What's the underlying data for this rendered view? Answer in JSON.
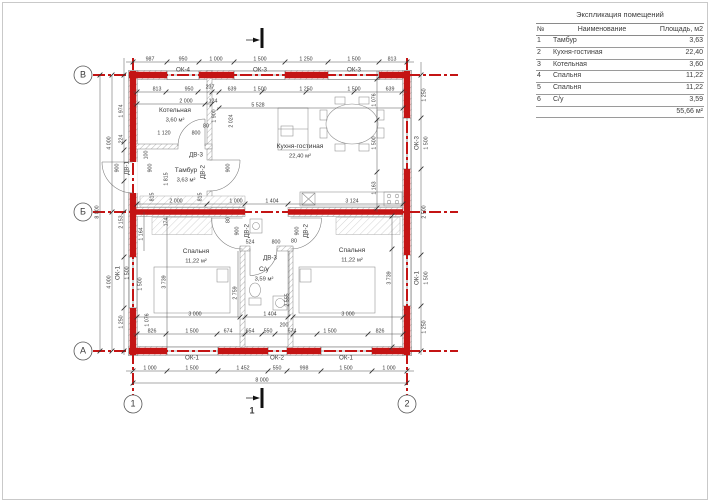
{
  "colors": {
    "axis_red": "#c41414"
  },
  "table": {
    "title": "Экспликация помещений",
    "headers": [
      "№",
      "Наименование",
      "Площадь, м2"
    ],
    "rows": [
      [
        "1",
        "Тамбур",
        "3,63"
      ],
      [
        "2",
        "Кухня-гостиная",
        "22,40"
      ],
      [
        "3",
        "Котельная",
        "3,60"
      ],
      [
        "4",
        "Спальня",
        "11,22"
      ],
      [
        "5",
        "Спальня",
        "11,22"
      ],
      [
        "6",
        "С/у",
        "3,59"
      ]
    ],
    "total": "55,66 м²"
  },
  "plan": {
    "labels": [
      {
        "t": "987",
        "x": 150,
        "y": 59
      },
      {
        "t": "950",
        "x": 183,
        "y": 59
      },
      {
        "t": "1 000",
        "x": 216,
        "y": 59
      },
      {
        "t": "1 500",
        "x": 260,
        "y": 59
      },
      {
        "t": "1 250",
        "x": 306,
        "y": 59
      },
      {
        "t": "1 500",
        "x": 354,
        "y": 59
      },
      {
        "t": "813",
        "x": 392,
        "y": 59
      },
      {
        "t": "ОК-4",
        "x": 183,
        "y": 70,
        "k": "win"
      },
      {
        "t": "ОК-3",
        "x": 260,
        "y": 70,
        "k": "win"
      },
      {
        "t": "ОК-3",
        "x": 354,
        "y": 70,
        "k": "win"
      },
      {
        "t": "813",
        "x": 157,
        "y": 89
      },
      {
        "t": "950",
        "x": 189,
        "y": 89
      },
      {
        "t": "237",
        "x": 210,
        "y": 87
      },
      {
        "t": "639",
        "x": 232,
        "y": 89
      },
      {
        "t": "1 500",
        "x": 260,
        "y": 89
      },
      {
        "t": "1 250",
        "x": 306,
        "y": 89
      },
      {
        "t": "1 500",
        "x": 354,
        "y": 89
      },
      {
        "t": "639",
        "x": 390,
        "y": 89
      },
      {
        "t": "2 000",
        "x": 186,
        "y": 101
      },
      {
        "t": "124",
        "x": 213,
        "y": 101
      },
      {
        "t": "5 528",
        "x": 258,
        "y": 105
      },
      {
        "t": "1 900",
        "x": 214,
        "y": 116,
        "r": 1
      },
      {
        "t": "2 024",
        "x": 231,
        "y": 121,
        "r": 1
      },
      {
        "t": "80",
        "x": 206,
        "y": 126
      },
      {
        "t": "800",
        "x": 196,
        "y": 133
      },
      {
        "t": "1 120",
        "x": 164,
        "y": 133
      },
      {
        "t": "Котельная",
        "x": 175,
        "y": 110,
        "k": "room"
      },
      {
        "t": "3,60 м²",
        "x": 175,
        "y": 120,
        "k": "area"
      },
      {
        "t": "ДВ-3",
        "x": 196,
        "y": 155,
        "k": "door"
      },
      {
        "t": "Тамбур",
        "x": 186,
        "y": 170,
        "k": "room"
      },
      {
        "t": "3,63 м²",
        "x": 186,
        "y": 180,
        "k": "area"
      },
      {
        "t": "ДВ-2",
        "x": 203,
        "y": 172,
        "r": 1,
        "k": "door"
      },
      {
        "t": "900",
        "x": 150,
        "y": 168,
        "r": 1
      },
      {
        "t": "900",
        "x": 228,
        "y": 168,
        "r": 1
      },
      {
        "t": "1 815",
        "x": 166,
        "y": 179,
        "r": 1
      },
      {
        "t": "100",
        "x": 146,
        "y": 155,
        "r": 1
      },
      {
        "t": "815",
        "x": 152,
        "y": 197,
        "r": 1
      },
      {
        "t": "815",
        "x": 200,
        "y": 197,
        "r": 1
      },
      {
        "t": "2 000",
        "x": 176,
        "y": 201
      },
      {
        "t": "1 000",
        "x": 236,
        "y": 201
      },
      {
        "t": "1 404",
        "x": 272,
        "y": 201
      },
      {
        "t": "3 124",
        "x": 352,
        "y": 201
      },
      {
        "t": "Кухня-гостиная",
        "x": 300,
        "y": 146,
        "k": "room"
      },
      {
        "t": "22,40 м²",
        "x": 300,
        "y": 156,
        "k": "area"
      },
      {
        "t": "1 076",
        "x": 374,
        "y": 100,
        "r": 1
      },
      {
        "t": "1 500",
        "x": 374,
        "y": 143,
        "r": 1
      },
      {
        "t": "1 163",
        "x": 374,
        "y": 188,
        "r": 1
      },
      {
        "t": "1 250",
        "x": 424,
        "y": 95,
        "r": 1
      },
      {
        "t": "ОК-3",
        "x": 417,
        "y": 143,
        "r": 1,
        "k": "win"
      },
      {
        "t": "1 500",
        "x": 426,
        "y": 143,
        "r": 1
      },
      {
        "t": "2 500",
        "x": 424,
        "y": 212,
        "r": 1
      },
      {
        "t": "ОК-1",
        "x": 417,
        "y": 278,
        "r": 1,
        "k": "win"
      },
      {
        "t": "1 500",
        "x": 426,
        "y": 278,
        "r": 1
      },
      {
        "t": "1 250",
        "x": 424,
        "y": 327,
        "r": 1
      },
      {
        "t": "8 000",
        "x": 97,
        "y": 212,
        "r": 1
      },
      {
        "t": "4 000",
        "x": 109,
        "y": 143,
        "r": 1
      },
      {
        "t": "4 000",
        "x": 109,
        "y": 282,
        "r": 1
      },
      {
        "t": "1 974",
        "x": 121,
        "y": 111,
        "r": 1
      },
      {
        "t": "224",
        "x": 121,
        "y": 139,
        "r": 1
      },
      {
        "t": "900",
        "x": 117,
        "y": 168,
        "r": 1
      },
      {
        "t": "ДВ-1",
        "x": 127,
        "y": 168,
        "r": 1,
        "k": "door"
      },
      {
        "t": "2 153",
        "x": 121,
        "y": 222,
        "r": 1
      },
      {
        "t": "ОК-1",
        "x": 118,
        "y": 273,
        "r": 1,
        "k": "win"
      },
      {
        "t": "1 500",
        "x": 127,
        "y": 273,
        "r": 1
      },
      {
        "t": "1 500",
        "x": 140,
        "y": 284,
        "r": 1
      },
      {
        "t": "1 250",
        "x": 121,
        "y": 322,
        "r": 1
      },
      {
        "t": "174",
        "x": 166,
        "y": 222,
        "r": 1
      },
      {
        "t": "1 164",
        "x": 141,
        "y": 234,
        "r": 1
      },
      {
        "t": "1 076",
        "x": 147,
        "y": 320,
        "r": 1
      },
      {
        "t": "80",
        "x": 228,
        "y": 220,
        "r": 1
      },
      {
        "t": "900",
        "x": 237,
        "y": 231,
        "r": 1
      },
      {
        "t": "ДВ-2",
        "x": 247,
        "y": 231,
        "r": 1,
        "k": "door"
      },
      {
        "t": "900",
        "x": 297,
        "y": 231,
        "r": 1
      },
      {
        "t": "ДВ-2",
        "x": 306,
        "y": 231,
        "r": 1,
        "k": "door"
      },
      {
        "t": "524",
        "x": 250,
        "y": 242
      },
      {
        "t": "800",
        "x": 276,
        "y": 242
      },
      {
        "t": "80",
        "x": 294,
        "y": 241
      },
      {
        "t": "ДВ-3",
        "x": 270,
        "y": 258,
        "k": "door"
      },
      {
        "t": "С/у",
        "x": 264,
        "y": 269,
        "k": "room"
      },
      {
        "t": "3,59 м²",
        "x": 264,
        "y": 279,
        "k": "area"
      },
      {
        "t": "Спальня",
        "x": 196,
        "y": 251,
        "k": "room"
      },
      {
        "t": "11,22 м²",
        "x": 196,
        "y": 261,
        "k": "area"
      },
      {
        "t": "Спальня",
        "x": 352,
        "y": 250,
        "k": "room"
      },
      {
        "t": "11,22 м²",
        "x": 352,
        "y": 260,
        "k": "area"
      },
      {
        "t": "3 739",
        "x": 164,
        "y": 282,
        "r": 1
      },
      {
        "t": "2 759",
        "x": 235,
        "y": 293,
        "r": 1
      },
      {
        "t": "2 555",
        "x": 287,
        "y": 300,
        "r": 1
      },
      {
        "t": "3 739",
        "x": 389,
        "y": 278,
        "r": 1
      },
      {
        "t": "1 404",
        "x": 270,
        "y": 314
      },
      {
        "t": "3 000",
        "x": 195,
        "y": 314
      },
      {
        "t": "3 000",
        "x": 348,
        "y": 314
      },
      {
        "t": "200",
        "x": 284,
        "y": 325
      },
      {
        "t": "826",
        "x": 152,
        "y": 331
      },
      {
        "t": "1 500",
        "x": 192,
        "y": 331
      },
      {
        "t": "674",
        "x": 228,
        "y": 331
      },
      {
        "t": "654",
        "x": 250,
        "y": 331
      },
      {
        "t": "550",
        "x": 268,
        "y": 331
      },
      {
        "t": "674",
        "x": 292,
        "y": 331
      },
      {
        "t": "1 500",
        "x": 330,
        "y": 331
      },
      {
        "t": "826",
        "x": 380,
        "y": 331
      },
      {
        "t": "ОК-1",
        "x": 192,
        "y": 358,
        "k": "win"
      },
      {
        "t": "ОК-2",
        "x": 277,
        "y": 358,
        "k": "win"
      },
      {
        "t": "ОК-1",
        "x": 346,
        "y": 358,
        "k": "win"
      },
      {
        "t": "1 000",
        "x": 150,
        "y": 368
      },
      {
        "t": "1 500",
        "x": 192,
        "y": 368
      },
      {
        "t": "1 452",
        "x": 243,
        "y": 368
      },
      {
        "t": "550",
        "x": 277,
        "y": 368
      },
      {
        "t": "998",
        "x": 304,
        "y": 368
      },
      {
        "t": "1 500",
        "x": 346,
        "y": 368
      },
      {
        "t": "1 000",
        "x": 389,
        "y": 368
      },
      {
        "t": "8 000",
        "x": 262,
        "y": 380
      },
      {
        "t": "1",
        "x": 252,
        "y": 411,
        "k": "sec"
      },
      {
        "t": "В",
        "x": 83,
        "y": 75,
        "k": "grid"
      },
      {
        "t": "Б",
        "x": 83,
        "y": 212,
        "k": "grid"
      },
      {
        "t": "А",
        "x": 83,
        "y": 351,
        "k": "grid"
      },
      {
        "t": "1",
        "x": 133,
        "y": 404,
        "k": "grid"
      },
      {
        "t": "2",
        "x": 407,
        "y": 404,
        "k": "grid"
      }
    ]
  }
}
